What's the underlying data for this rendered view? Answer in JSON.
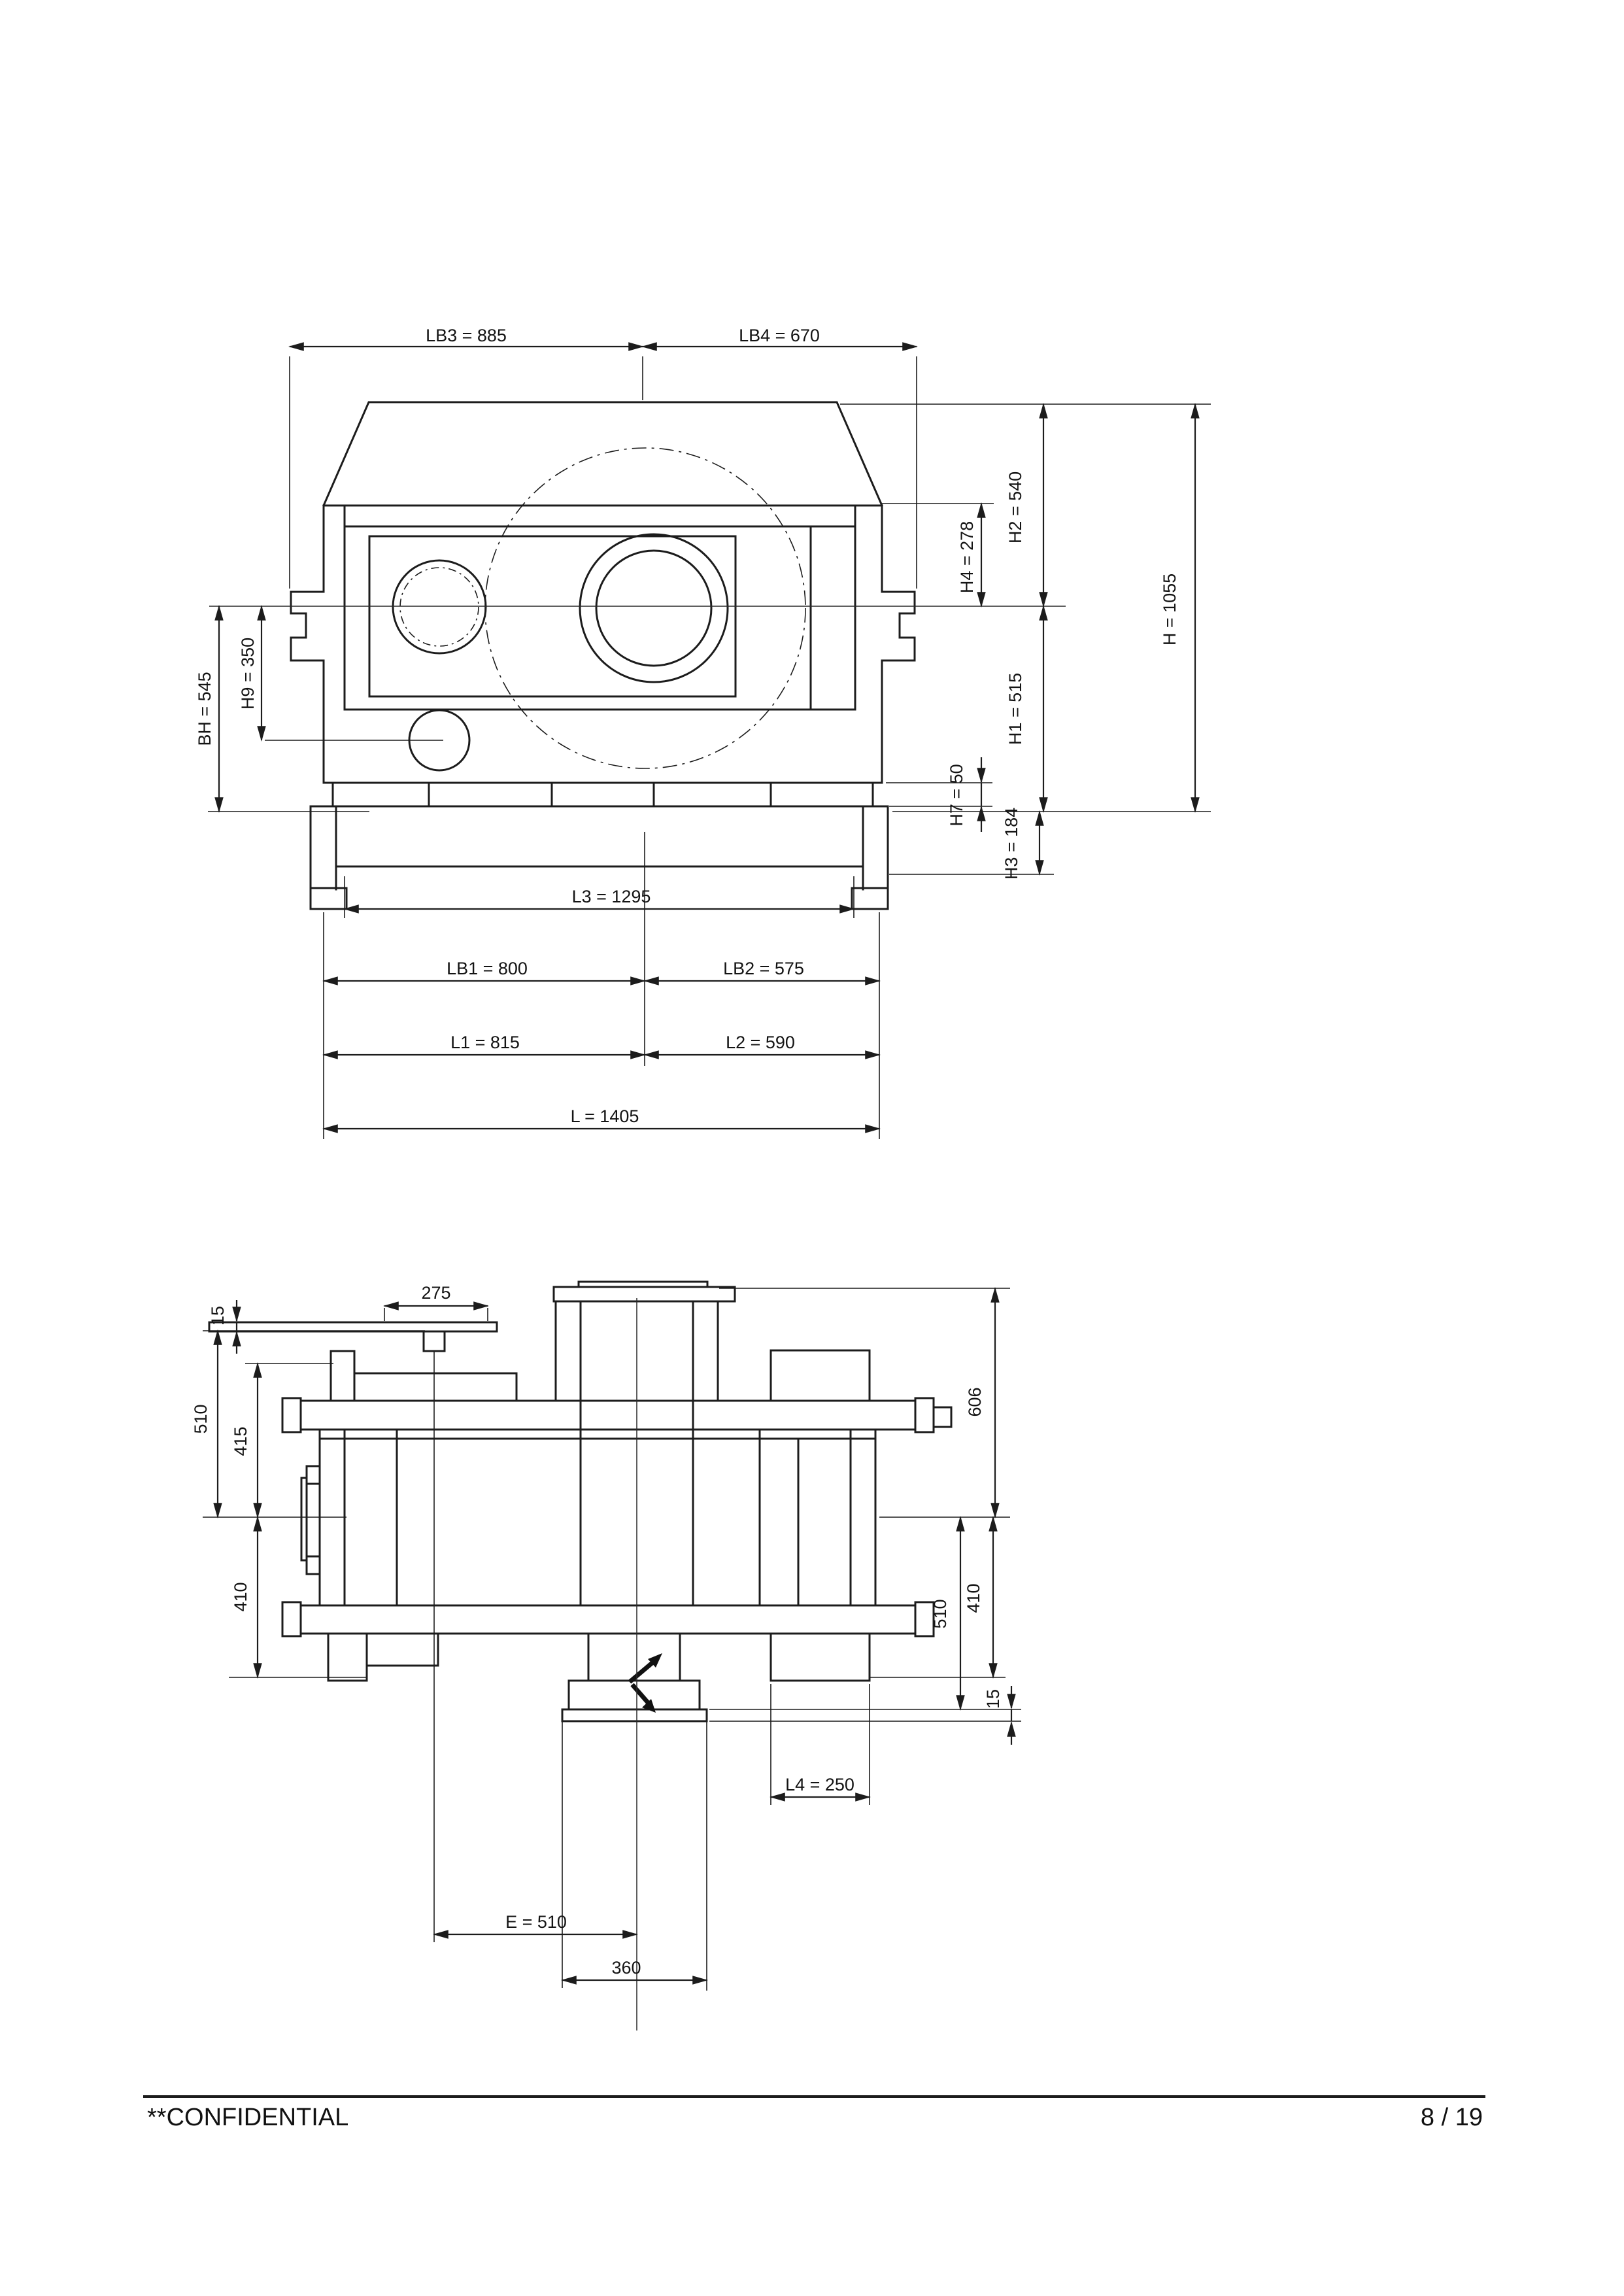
{
  "front_view": {
    "lb3": "LB3 = 885",
    "lb4": "LB4 = 670",
    "bh": "BH = 545",
    "h9": "H9 = 350",
    "h4": "H4 = 278",
    "h2": "H2 = 540",
    "h": "H = 1055",
    "h1": "H1 = 515",
    "h7": "H7 = 50",
    "h3": "H3 = 184",
    "l3": "L3 = 1295",
    "lb1": "LB1 = 800",
    "lb2": "LB2 = 575",
    "l1": "L1 = 815",
    "l2": "L2 = 590",
    "l": "L = 1405"
  },
  "plan_view": {
    "d275": "275",
    "d15_left": "15",
    "d510_left": "510",
    "d415": "415",
    "d410_left": "410",
    "d606": "606",
    "d410_right": "410",
    "d510_right": "510",
    "d15_right": "15",
    "l4": "L4 = 250",
    "e": "E = 510",
    "d360": "360"
  },
  "footer": {
    "confidential": "**CONFIDENTIAL",
    "page": "8 / 19"
  }
}
